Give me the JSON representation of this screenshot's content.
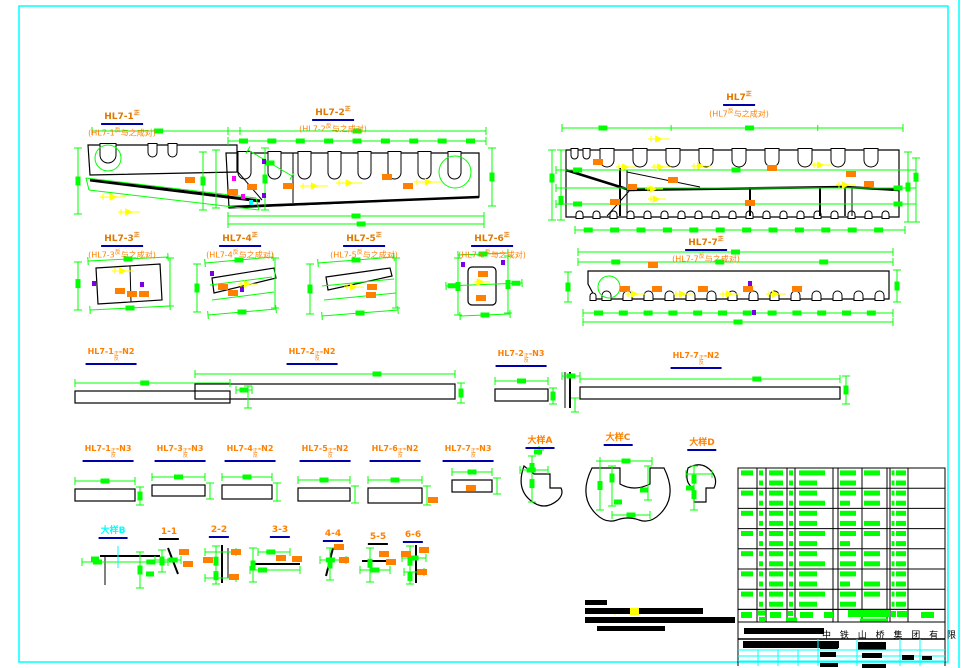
{
  "drawing": {
    "views": [
      {
        "title_base": "HL7-1",
        "title_sup": "正",
        "note_pre": "(HL7-1",
        "note_sup": "反",
        "note_post": "与之成对)"
      },
      {
        "title_base": "HL7-2",
        "title_sup": "正",
        "note_pre": "(HL7-2",
        "note_sup": "反",
        "note_post": "与之成对)"
      },
      {
        "title_base": "HL7",
        "title_sup": "正",
        "note_pre": "(HL7",
        "note_sup": "反",
        "note_post": "与之成对)"
      },
      {
        "title_base": "HL7-3",
        "title_sup": "正",
        "note_pre": "(HL7-3",
        "note_sup": "反",
        "note_post": "与之成对)"
      },
      {
        "title_base": "HL7-4",
        "title_sup": "正",
        "note_pre": "(HL7-4",
        "note_sup": "反",
        "note_post": "与之成对)"
      },
      {
        "title_base": "HL7-5",
        "title_sup": "正",
        "note_pre": "(HL7-5",
        "note_sup": "反",
        "note_post": "与之成对)"
      },
      {
        "title_base": "HL7-6",
        "title_sup": "正",
        "note_pre": "(HL7-6",
        "note_sup": "反",
        "note_post": "与之成对)"
      },
      {
        "title_base": "HL7-7",
        "title_sup": "正",
        "note_pre": "(HL7-7",
        "note_sup": "反",
        "note_post": "与之成对)"
      }
    ],
    "plate_labels_row3": [
      {
        "pre": "HL7-1",
        "top": "正",
        "bot": "反",
        "post": "-N2"
      },
      {
        "pre": "HL7-2",
        "top": "正",
        "bot": "反",
        "post": "-N2"
      },
      {
        "pre": "HL7-2",
        "top": "正",
        "bot": "反",
        "post": "-N3"
      },
      {
        "pre": "HL7-7",
        "top": "正",
        "bot": "反",
        "post": "-N2"
      }
    ],
    "plate_labels_row4": [
      {
        "pre": "HL7-1",
        "top": "正",
        "bot": "反",
        "post": "-N3"
      },
      {
        "pre": "HL7-3",
        "top": "正",
        "bot": "反",
        "post": "-N3"
      },
      {
        "pre": "HL7-4",
        "top": "正",
        "bot": "反",
        "post": "-N2"
      },
      {
        "pre": "HL7-5",
        "top": "正",
        "bot": "反",
        "post": "-N2"
      },
      {
        "pre": "HL7-6",
        "top": "正",
        "bot": "反",
        "post": "-N2"
      },
      {
        "pre": "HL7-7",
        "top": "正",
        "bot": "反",
        "post": "-N3"
      }
    ],
    "details": [
      {
        "label": "大样A"
      },
      {
        "label": "大样C"
      },
      {
        "label": "大样D"
      },
      {
        "label": "大样B"
      }
    ],
    "sections": [
      {
        "label": "1-1"
      },
      {
        "label": "2-2"
      },
      {
        "label": "3-3"
      },
      {
        "label": "4-4"
      },
      {
        "label": "5-5"
      },
      {
        "label": "6-6"
      }
    ]
  },
  "title_block": {
    "company": "中 铁 山 桥 集 团 有 限 公 司"
  },
  "colors": {
    "dimension_green": "#00ff00",
    "label_orange": "#ff8000",
    "weld_yellow": "#ffff00",
    "frame_cyan": "#00ffff",
    "underline_blue": "#0000a8",
    "mark_magenta": "#ff00ff",
    "mark_purple": "#7a00e6",
    "line_black": "#000000"
  }
}
